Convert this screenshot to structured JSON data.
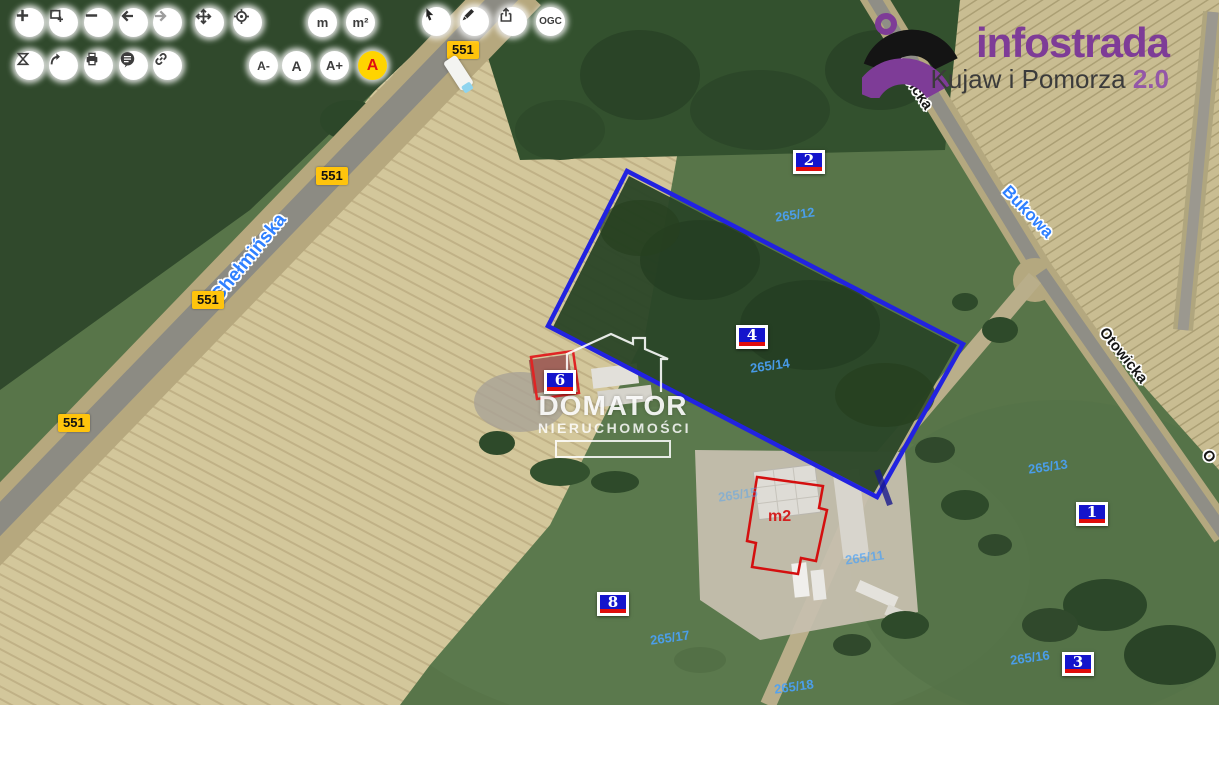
{
  "logo": {
    "brand": "infostrada",
    "region": "Kujaw i Pomorza ",
    "version": "2.0"
  },
  "watermark": {
    "title": "DOMATOR",
    "subtitle": "NIERUCHOMOŚCI"
  },
  "toolbar": {
    "measure_length": "m",
    "measure_area": "m²",
    "ogc": "OGC",
    "font_decrease": "A-",
    "font_reset": "A",
    "font_increase": "A+",
    "high_contrast": "A"
  },
  "road_number": "551",
  "streets": [
    {
      "label": "Chełmińska"
    },
    {
      "label": "Otowicka"
    },
    {
      "label": "Bukowa"
    },
    {
      "label": "Otowicka"
    },
    {
      "label": "O"
    }
  ],
  "parcels": [
    {
      "label": "236"
    },
    {
      "label": "265/12"
    },
    {
      "label": "265/14"
    },
    {
      "label": "265/13"
    },
    {
      "label": "265/15"
    },
    {
      "label": "265/11"
    },
    {
      "label": "265/17"
    },
    {
      "label": "265/16"
    },
    {
      "label": "265/18"
    }
  ],
  "markers": [
    {
      "label": "2"
    },
    {
      "label": "4"
    },
    {
      "label": "6"
    },
    {
      "label": "1"
    },
    {
      "label": "8"
    },
    {
      "label": "3"
    }
  ],
  "construction_area_label": "m2",
  "colors": {
    "brand_purple": "#7e3c97",
    "parcel_outline_blue": "#2222e0",
    "building_outline_red": "#d42020",
    "marker_blue": "#1414cc",
    "marker_stripe_red": "#e00c0c",
    "road_badge_yellow": "#ffc40c",
    "parcel_label_blue": "#4aa2f8",
    "street_label_blue": "#2f80ff",
    "contrast_button_yellow": "#ffd400"
  }
}
